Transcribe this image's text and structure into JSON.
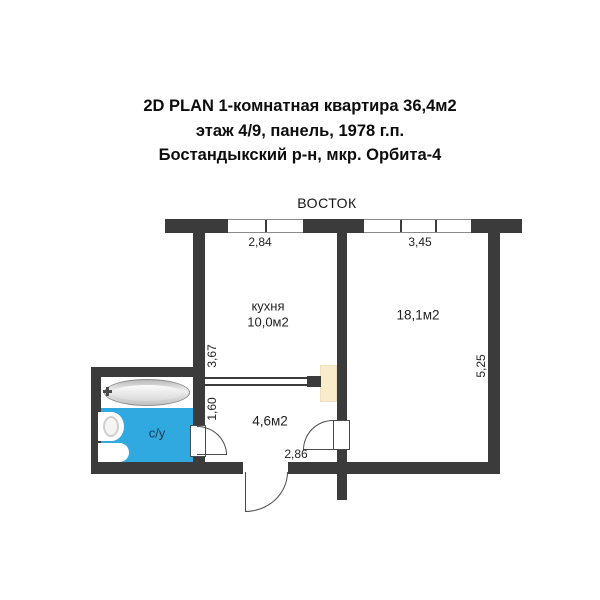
{
  "header": {
    "line1": "2D PLAN 1-комнатная квартира 36,4м2",
    "line2": "этаж 4/9, панель, 1978 г.п.",
    "line3": "Бостандыкский р-н, мкр. Орбита-4"
  },
  "plan": {
    "orientation": "ВОСТОК",
    "rooms": {
      "kitchen": {
        "name": "кухня",
        "area": "10,0м2"
      },
      "living": {
        "area": "18,1м2"
      },
      "hall": {
        "area": "4,6м2"
      },
      "bathroom": {
        "label": "с/у"
      }
    },
    "dimensions": {
      "kitchen_width": "2,84",
      "living_width": "3,45",
      "kitchen_depth": "3,67",
      "hall_depth": "1,60",
      "living_depth": "5,25",
      "hall_width": "2,86"
    },
    "colors": {
      "wall": "#3b3b3b",
      "bathroom_fill": "#2fa9e0",
      "closet_fill": "#f9ecca",
      "door_arc": "#4a4a4a"
    }
  }
}
